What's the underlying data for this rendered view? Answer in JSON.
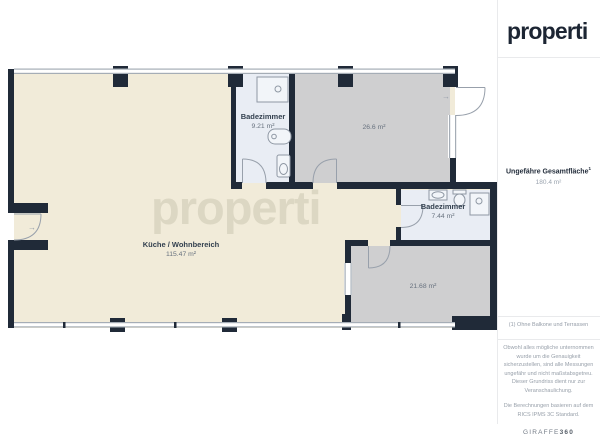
{
  "header": {
    "logo_text": "properti"
  },
  "watermark_text": "properti",
  "floorplan": {
    "rooms": {
      "bath_top": {
        "name": "Badezimmer",
        "area": "9.21 m²"
      },
      "room_top_right": {
        "area": "26.6 m²"
      },
      "kitchen_living": {
        "name": "Küche / Wohnbereich",
        "area": "115.47 m²"
      },
      "bath_right": {
        "name": "Badezimmer",
        "area": "7.44 m²"
      },
      "room_bottom_right": {
        "area": "21.68 m²"
      }
    }
  },
  "icons": {
    "entrance_arrow": "→",
    "room_door_arrow": "→"
  },
  "sidebar": {
    "total_area": {
      "label": "Ungefähre Gesamtfläche",
      "sup": "1",
      "value": "180.4 m²"
    },
    "footnote": "(1) Ohne Balkone und Terrassen",
    "disclaimer_measurements": "Obwohl alles mögliche unternommen wurde um die Genauigkeit sicherzustellen, sind alle Messungen ungefähr und nicht maßstabsgetreu. Dieser Grundriss dient nur zur Veranschaulichung.",
    "disclaimer_standard": "Die Berechnungen basieren auf dem RICS IPMS 3C Standard.",
    "provider": {
      "name": "GIRAFFE",
      "suffix": "360"
    }
  },
  "colors": {
    "wall": "#202a38",
    "floor_main": "#f1ebd9",
    "floor_room": "#cfcfd0",
    "floor_bath": "#e9edf4",
    "window_line": "#a5adb6",
    "door_stroke": "#98a0ab",
    "logo_text": "#1c2533",
    "label_dark": "#33404f",
    "label_gray": "#68727f"
  }
}
